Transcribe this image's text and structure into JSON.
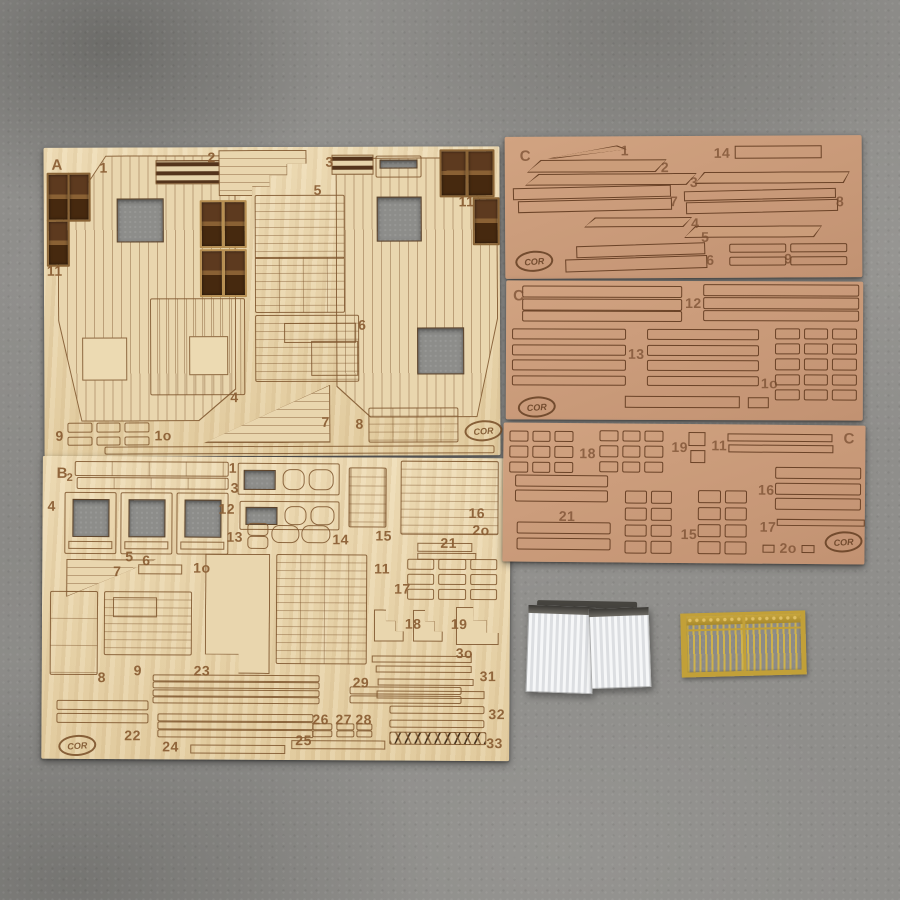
{
  "scene": {
    "background_color": "#8f8e8b",
    "plywood_color": "#e9d6ae",
    "mdf_color": "#cb9d7a",
    "engraving_color": "#7c532c",
    "window_glass_color": "#53321a",
    "cutout_color": "#8d8d8a",
    "brass_color": "#c2a038",
    "paper_color": "#f2f3f5"
  },
  "sheet_a": {
    "label": "A",
    "logo": "COR",
    "part_numbers": {
      "p1": "1",
      "p2": "2",
      "p3": "3",
      "p4": "4",
      "p5": "5",
      "p6": "6",
      "p7": "7",
      "p8": "8",
      "p9": "9",
      "p10": "1o",
      "p11_left": "11",
      "p11_right": "11"
    }
  },
  "sheet_b": {
    "label": "B",
    "logo": "COR",
    "part_numbers": {
      "p1": "1",
      "p2": "2",
      "p3": "3",
      "p4": "4",
      "p5": "5",
      "p6": "6",
      "p7": "7",
      "p8": "8",
      "p9": "9",
      "p10": "1o",
      "p11": "11",
      "p12": "12",
      "p13": "13",
      "p14": "14",
      "p15": "15",
      "p16": "16",
      "p17": "17",
      "p18": "18",
      "p19": "19",
      "p20": "2o",
      "p21": "21",
      "p22": "22",
      "p23": "23",
      "p24": "24",
      "p25": "25",
      "p26": "26",
      "p27": "27",
      "p28": "28",
      "p29": "29",
      "p30": "3o",
      "p31": "31",
      "p32": "32",
      "p33": "33"
    }
  },
  "sheet_c1": {
    "label": "C",
    "logo": "COR",
    "part_numbers": {
      "p1": "1",
      "p2": "2",
      "p3": "3",
      "p4": "4",
      "p5": "5",
      "p6": "6",
      "p7": "7",
      "p8": "8",
      "p9": "9",
      "p14": "14"
    }
  },
  "sheet_c2": {
    "label": "C",
    "logo": "COR",
    "part_numbers": {
      "p10": "1o",
      "p12": "12",
      "p13": "13"
    }
  },
  "sheet_c3": {
    "label": "C",
    "logo": "COR",
    "part_numbers": {
      "p11": "11",
      "p15": "15",
      "p16": "16",
      "p17": "17",
      "p18": "18",
      "p19": "19",
      "p20": "2o",
      "p21": "21"
    }
  }
}
